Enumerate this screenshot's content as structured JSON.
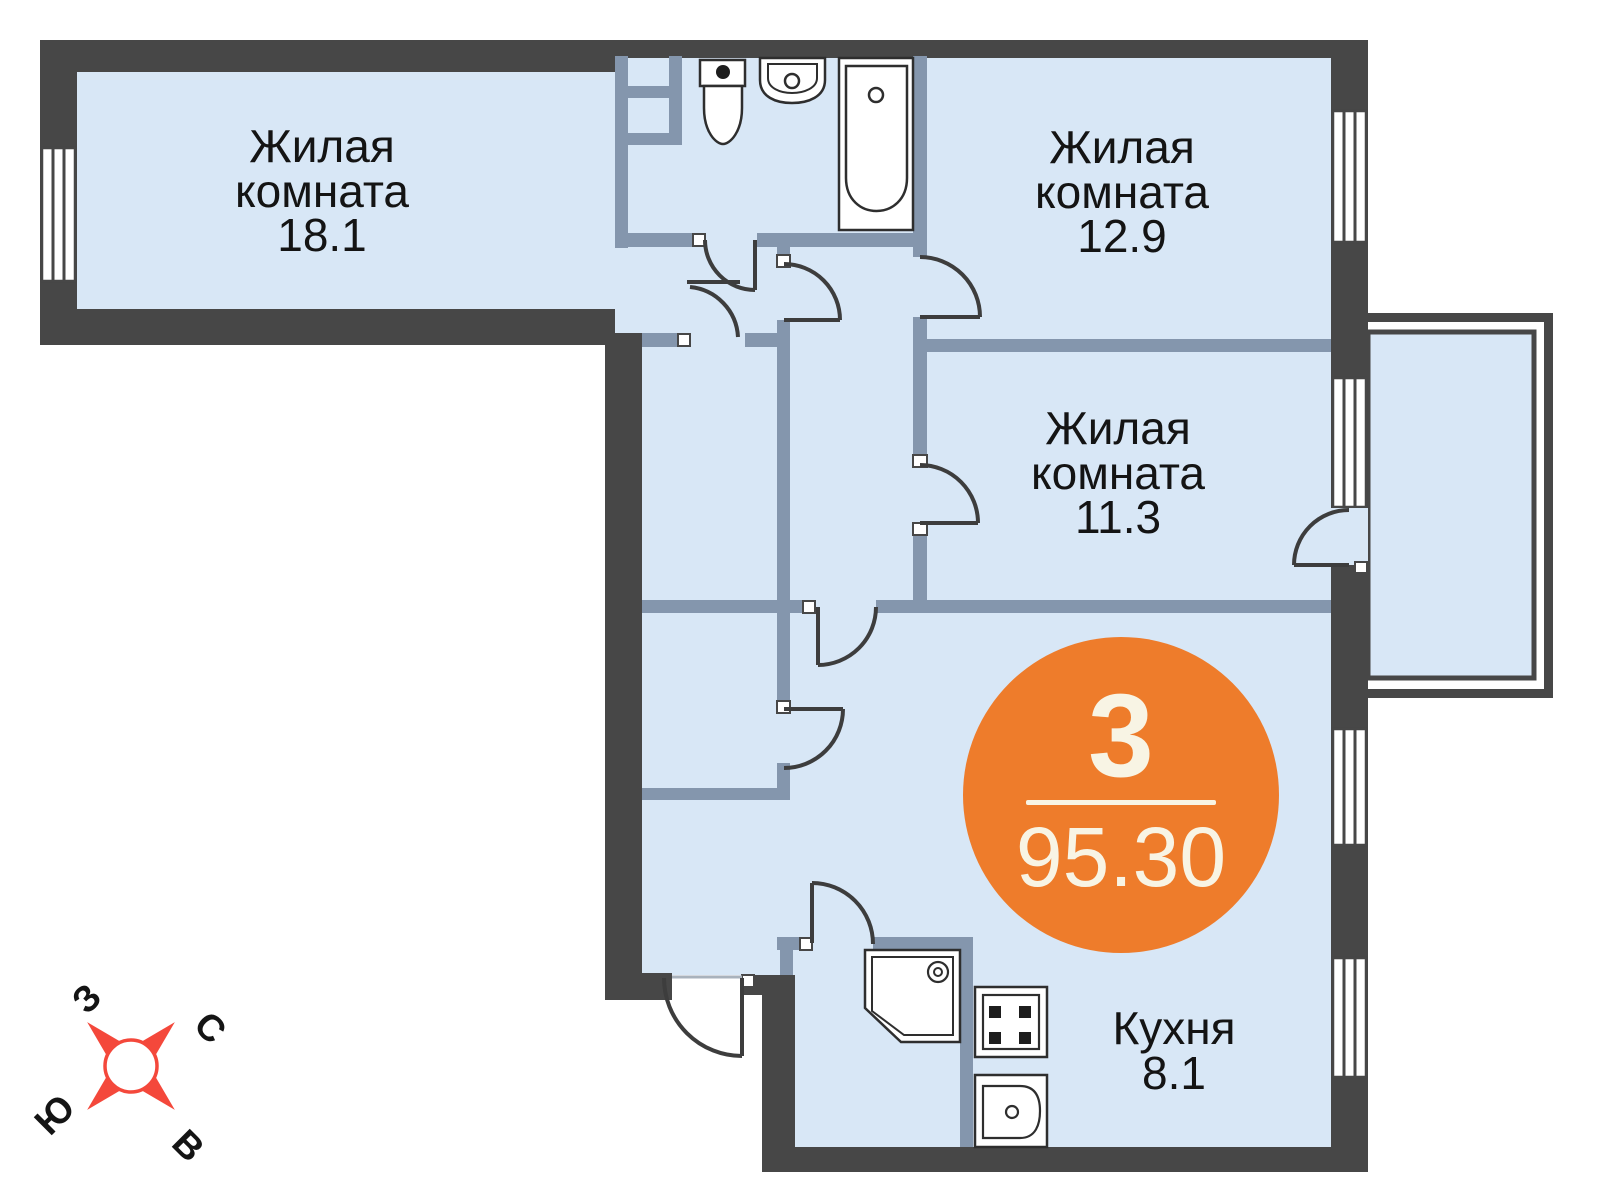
{
  "plan": {
    "title": "3-room apartment floor plan",
    "rooms": [
      {
        "type_line1": "Жилая",
        "type_line2": "комната",
        "area": "18.1"
      },
      {
        "type_line1": "Жилая",
        "type_line2": "комната",
        "area": "12.9"
      },
      {
        "type_line1": "Жилая",
        "type_line2": "комната",
        "area": "11.3"
      },
      {
        "type_line1": "Кухня",
        "area": "8.1"
      }
    ],
    "badge": {
      "rooms_count": "3",
      "total_area": "95.30"
    },
    "compass": {
      "west": "З",
      "north": "С",
      "south": "Ю",
      "east": "В"
    },
    "colors": {
      "floor": "#d8e7f6",
      "wall_dark": "#474747",
      "wall_inner": "#8496ad",
      "accent_orange": "#ee7c2b",
      "badge_text": "#f8f4e4",
      "compass_red": "#f4483b",
      "label_text": "#141414"
    }
  }
}
